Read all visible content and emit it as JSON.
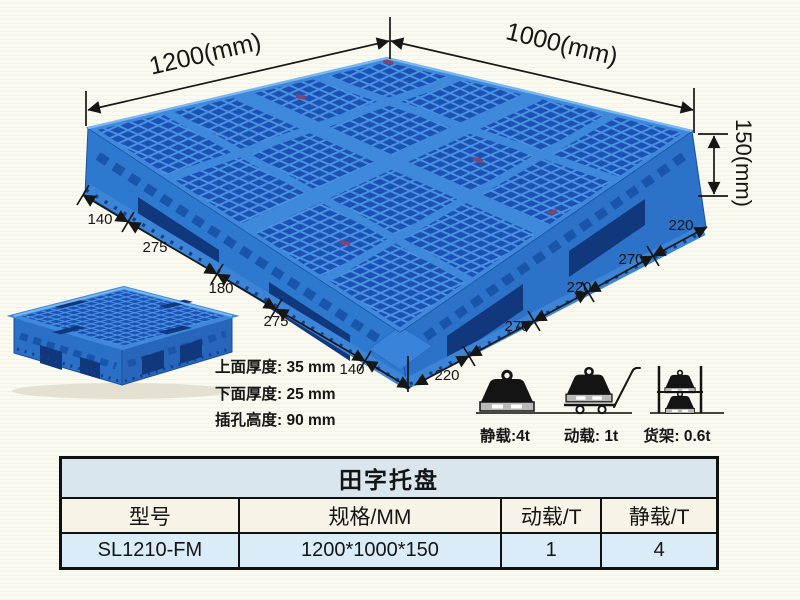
{
  "scene": {
    "dims": {
      "length_label": "1200(mm)",
      "width_label": "1000(mm)",
      "height_label": "150(mm)",
      "left_chain": [
        "140",
        "275",
        "180",
        "275",
        "140"
      ],
      "right_chain": [
        "220",
        "270",
        "220",
        "270",
        "220"
      ]
    },
    "thickness_notes": {
      "top": "上面厚度: 35 mm",
      "bottom": "下面厚度: 25 mm",
      "fork": "插孔高度: 90 mm"
    },
    "load_icons": {
      "static_label": "静载:4t",
      "dynamic_label": "动载: 1t",
      "rack_label": "货架: 0.6t"
    }
  },
  "spec_table": {
    "title": "田字托盘",
    "headers": [
      "型号",
      "规格/MM",
      "动载/T",
      "静载/T"
    ],
    "rows": [
      {
        "model": "SL1210-FM",
        "size": "1200*1000*150",
        "dynamic_load": "1",
        "static_load": "4"
      }
    ]
  },
  "colors": {
    "pallet_blue": "#2e79d0",
    "pallet_hole_blue": "#1c52b6",
    "pallet_rib_blue": "#4a92e2",
    "table_title_bg": "#d9e6ee",
    "table_header_bg": "#f7f3e7",
    "table_row_bg": "#d9ecf8",
    "background": "#fbfaf0"
  }
}
